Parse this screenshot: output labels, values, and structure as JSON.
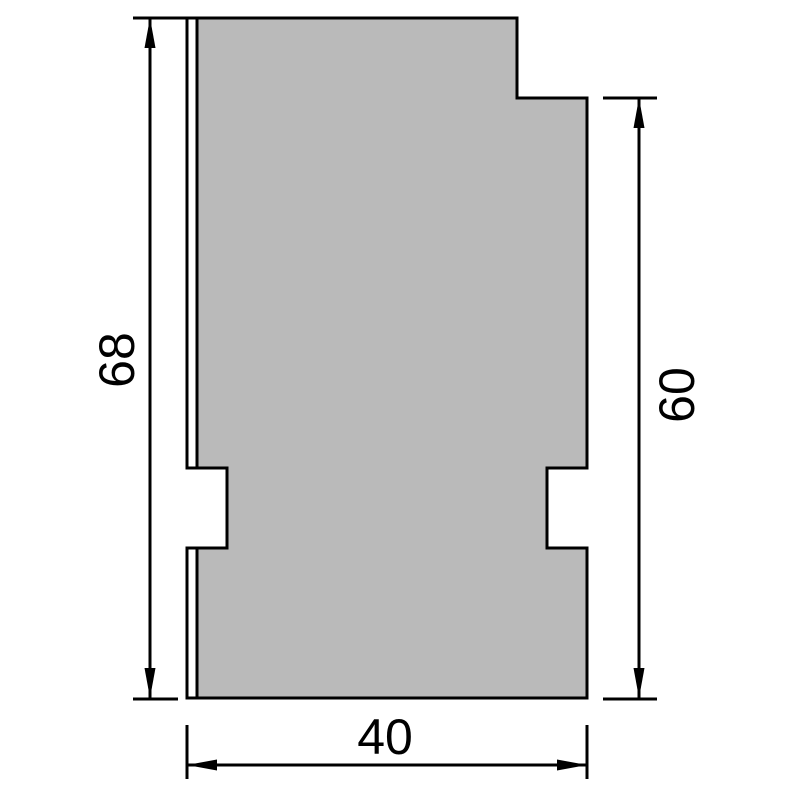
{
  "drawing": {
    "colors": {
      "background": "#ffffff",
      "line": "#000000",
      "body_fill": "#bababa"
    },
    "profile": {
      "outline_path": "M187 18 L517 18 L517 98 L587 98 L587 468 L547 468 L547 548 L587 548 L587 698 L187 698 L187 548 L227 548 L227 468 L187 468 Z",
      "body_path": "M197 18 L517 18 L517 98 L587 98 L587 468 L547 468 L547 548 L587 548 L587 698 L197 698 L197 548 L227 548 L227 468 L197 468 Z"
    },
    "dimensions": {
      "left": {
        "value": "68",
        "line": "M150 18 L150 698",
        "ext_top": "M133 18 L190 18",
        "ext_bottom": "M133 699 L178 699",
        "arrow_top": "150,18 144.5,48 155.5,48",
        "arrow_bottom": "150,698 144.5,668 155.5,668"
      },
      "right": {
        "value": "60",
        "line": "M639 98 L639 698",
        "ext_top": "M603 98 L657 98",
        "ext_bottom": "M603 699 L657 699",
        "arrow_top": "639,98 633.5,128 644.5,128",
        "arrow_bottom": "639,698 633.5,668 644.5,668"
      },
      "bottom": {
        "value": "40",
        "line": "M187 765 L587 765",
        "ext_left": "M187 725 L187 779",
        "ext_right": "M587 725 L587 779",
        "arrow_left": "187,765 217,759.5 217,770.5",
        "arrow_right": "587,765 557,759.5 557,770.5"
      }
    }
  }
}
